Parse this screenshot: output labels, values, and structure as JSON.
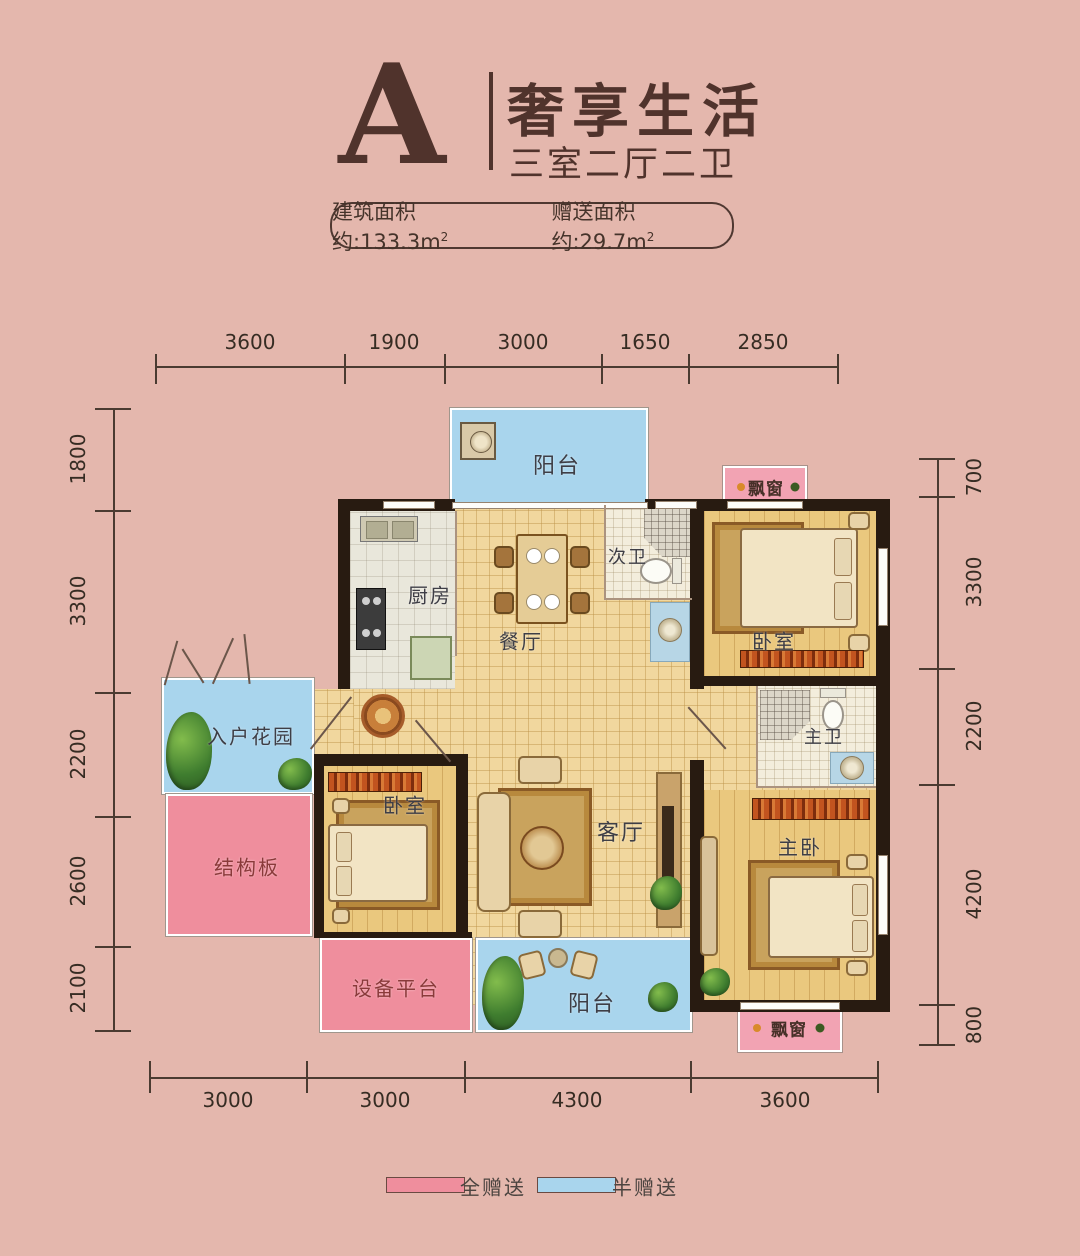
{
  "title": {
    "plan_letter": "A",
    "headline": "奢享生活",
    "subhead": "三室二厅二卫"
  },
  "area_pill": {
    "built": "建筑面积约:133.3m",
    "built_sup": "2",
    "gift": "赠送面积约:29.7m",
    "gift_sup": "2"
  },
  "dims": {
    "top": [
      "3600",
      "1900",
      "3000",
      "1650",
      "2850"
    ],
    "bottom": [
      "3000",
      "3000",
      "4300",
      "3600"
    ],
    "left": [
      "1800",
      "3300",
      "2200",
      "2600",
      "2100"
    ],
    "right": [
      "700",
      "3300",
      "2200",
      "4200",
      "800"
    ]
  },
  "rooms": {
    "balcony_top": "阳台",
    "kitchen": "厨房",
    "dining": "餐厅",
    "bath2": "次卫",
    "bedroom2": "卧室",
    "foyer_garden": "入户花园",
    "structural": "结构板",
    "bedroom3": "卧室",
    "living": "客厅",
    "bath_master": "主卫",
    "bedroom_master": "主卧",
    "equipment": "设备平台",
    "balcony_bottom": "阳台",
    "bay_top": "飘窗",
    "bay_bottom": "飘窗"
  },
  "legend": {
    "full": "全赠送",
    "half": "半赠送"
  },
  "colors": {
    "background": "#e4b7ad",
    "full_gift": "#ef8e9d",
    "half_gift": "#a9d5ed",
    "wall": "#281b11",
    "title_accent": "#50332c"
  }
}
